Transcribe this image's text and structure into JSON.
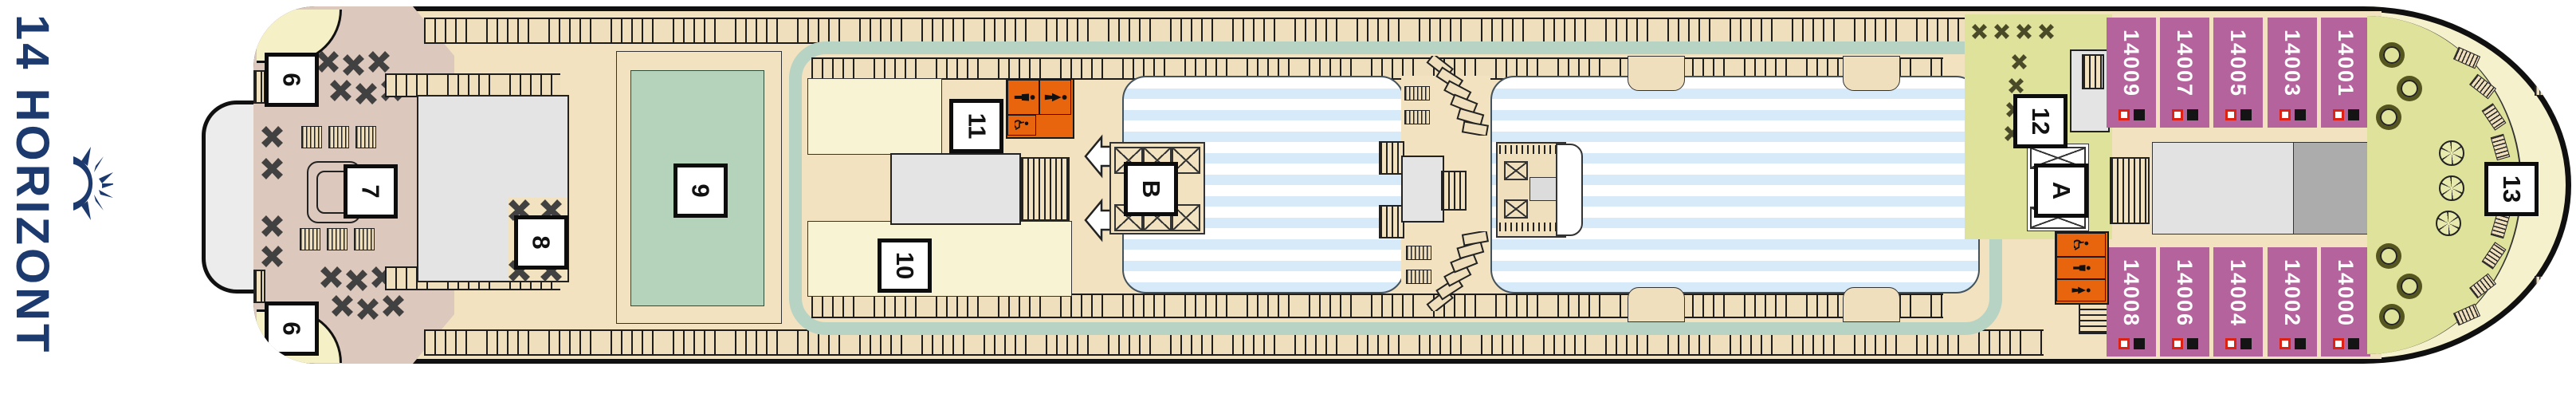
{
  "deck": {
    "title": "14 HORIZONT"
  },
  "logo": {
    "name": "sun-logo"
  },
  "markers": [
    {
      "id": "marker-6-aft-top",
      "label": "6"
    },
    {
      "id": "marker-6-aft-bottom",
      "label": "6"
    },
    {
      "id": "marker-7",
      "label": "7"
    },
    {
      "id": "marker-8",
      "label": "8"
    },
    {
      "id": "marker-9",
      "label": "9"
    },
    {
      "id": "marker-10",
      "label": "10"
    },
    {
      "id": "marker-11",
      "label": "11"
    },
    {
      "id": "marker-B",
      "label": "B"
    },
    {
      "id": "marker-12",
      "label": "12"
    },
    {
      "id": "marker-A",
      "label": "A"
    },
    {
      "id": "marker-13",
      "label": "13"
    }
  ],
  "cabins": {
    "top": [
      "14009",
      "14007",
      "14005",
      "14003",
      "14001"
    ],
    "bottom": [
      "14008",
      "14006",
      "14004",
      "14002",
      "14000"
    ]
  },
  "colors": {
    "label_navy": "#1c3a6e",
    "deck_tan": "#f2e2c0",
    "stern_pink": "#dcc8bd",
    "pale_yellow": "#f6f1cd",
    "track_green": "#b7d3c3",
    "court_green": "#b5d2bb",
    "room_yellow": "#f8f3d2",
    "olive_green": "#dfe29b",
    "pool_stripe_blue": "#d7eaf9",
    "cabin_magenta": "#b4639c",
    "wc_orange": "#e8650d",
    "indicator_red": "#dd2214",
    "indicator_black": "#141414"
  }
}
